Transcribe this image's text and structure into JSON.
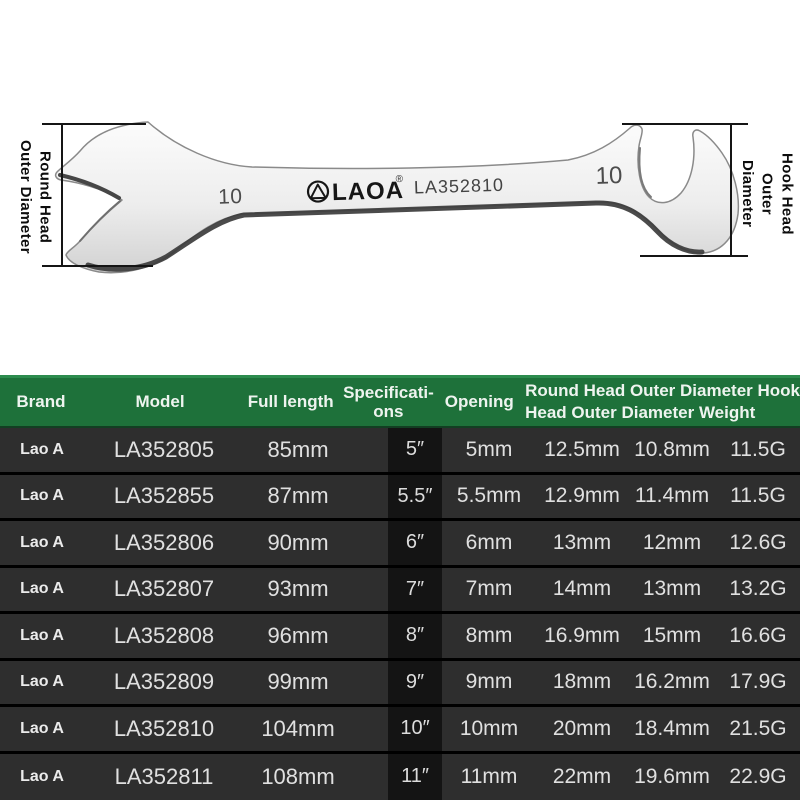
{
  "product": {
    "left_dimension_label": [
      "Round Head",
      "Outer Diameter"
    ],
    "right_dimension_label": [
      "Hook Head",
      "Outer",
      "Diameter"
    ],
    "engravings": {
      "left_size": "10",
      "brand": "LAOA",
      "reg_mark": "®",
      "model": "LA352810",
      "right_size": "10"
    }
  },
  "table": {
    "headers": {
      "brand": "Brand",
      "model": "Model",
      "full_length": "Full length",
      "specifications_lines": [
        "Specificati-",
        "ons"
      ],
      "opening": "Opening",
      "merged_lines": [
        "Round Head Outer Diameter Hook",
        "Head Outer Diameter Weight"
      ]
    },
    "rows": [
      [
        "Lao A",
        "LA352805",
        "85mm",
        "5″",
        "5mm",
        "12.5mm",
        "10.8mm",
        "11.5G"
      ],
      [
        "Lao A",
        "LA352855",
        "87mm",
        "5.5″",
        "5.5mm",
        "12.9mm",
        "11.4mm",
        "11.5G"
      ],
      [
        "Lao A",
        "LA352806",
        "90mm",
        "6″",
        "6mm",
        "13mm",
        "12mm",
        "12.6G"
      ],
      [
        "Lao A",
        "LA352807",
        "93mm",
        "7″",
        "7mm",
        "14mm",
        "13mm",
        "13.2G"
      ],
      [
        "Lao A",
        "LA352808",
        "96mm",
        "8″",
        "8mm",
        "16.9mm",
        "15mm",
        "16.6G"
      ],
      [
        "Lao A",
        "LA352809",
        "99mm",
        "9″",
        "9mm",
        "18mm",
        "16.2mm",
        "17.9G"
      ],
      [
        "Lao A",
        "LA352810",
        "104mm",
        "10″",
        "10mm",
        "20mm",
        "18.4mm",
        "21.5G"
      ],
      [
        "Lao A",
        "LA352811",
        "108mm",
        "11″",
        "11mm",
        "22mm",
        "19.6mm",
        "22.9G"
      ]
    ]
  },
  "colors": {
    "header_green": "#1e713a",
    "header_green_edge": "#2c8c4e",
    "row_background": "#2e2e2e",
    "spec_band_background": "#141414",
    "separator": "#000000",
    "header_text": "#eef4ef",
    "row_text": "#e0e0e0",
    "wrench_shadow": "#3c3c3c"
  }
}
